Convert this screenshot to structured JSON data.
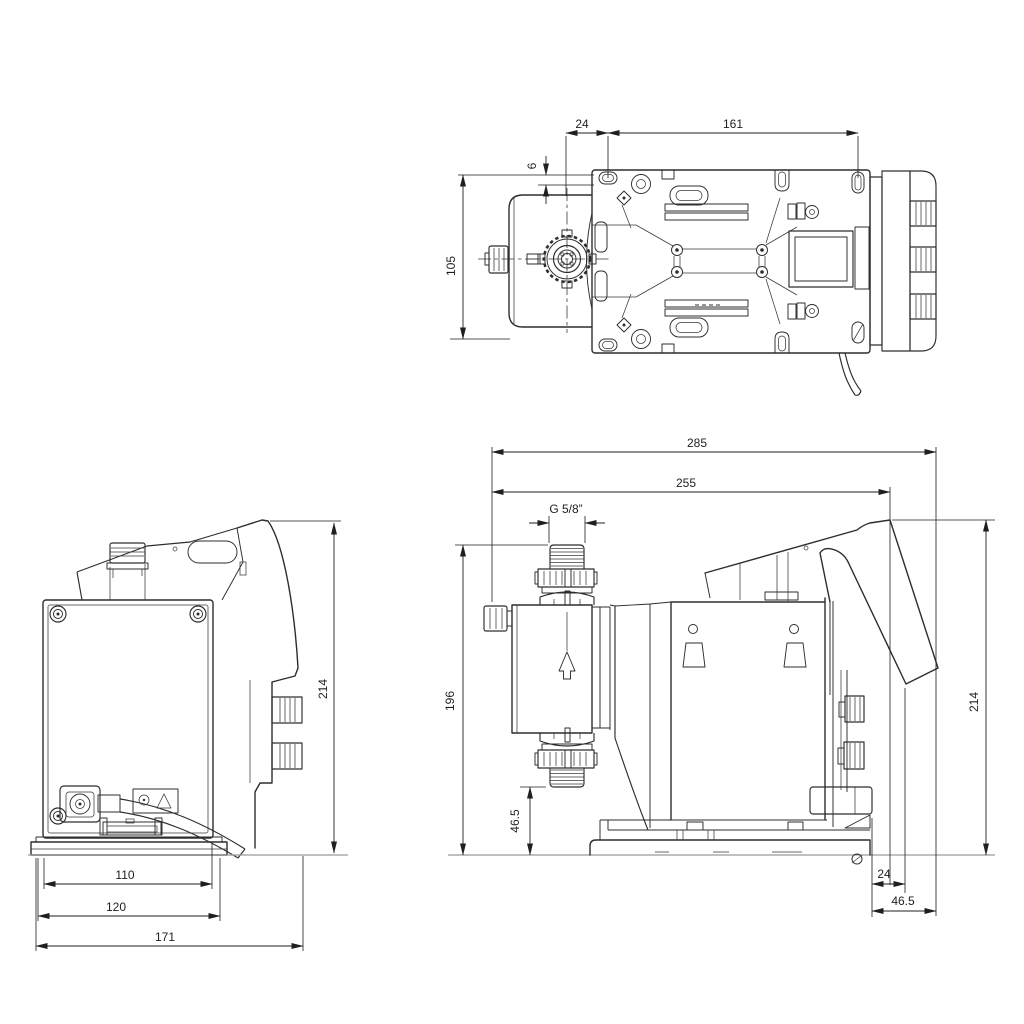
{
  "drawing": {
    "colors": {
      "background": "#ffffff",
      "outline": "#2d2d2d",
      "dimension_line": "#1f1f1f",
      "ground_line": "#9a9a9a",
      "text": "#1f1f1f"
    },
    "views": {
      "top": {
        "dims": {
          "w24": "24",
          "w161": "161",
          "h6": "6",
          "h105": "105"
        }
      },
      "rear": {
        "dims": {
          "w110": "110",
          "w120": "120",
          "w171": "171",
          "h214": "214"
        }
      },
      "side": {
        "dims": {
          "w285": "285",
          "w255": "255",
          "thread": "G 5/8”",
          "h196": "196",
          "h46_5": "46.5",
          "h214": "214",
          "w24": "24",
          "w46_5": "46.5"
        }
      }
    }
  }
}
